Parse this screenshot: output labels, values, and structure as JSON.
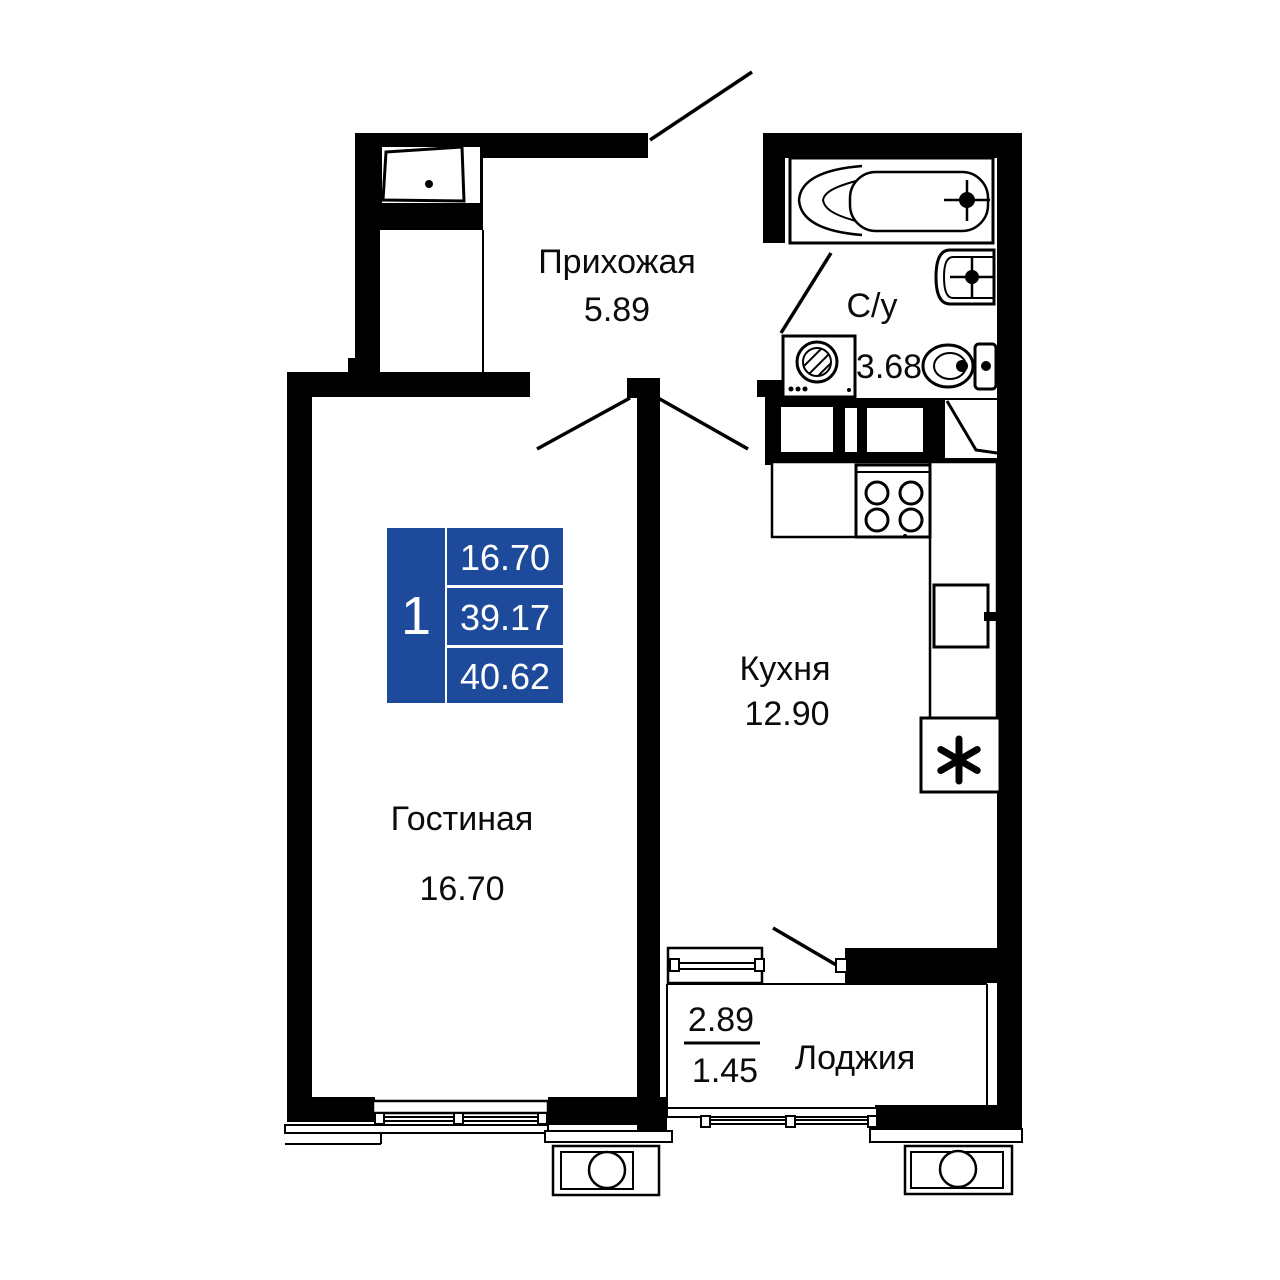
{
  "plan": {
    "background_color": "#ffffff",
    "wall_color": "#000000",
    "accent_blue": "#1d4a9b",
    "rooms": [
      {
        "id": "hallway",
        "label": "Прихожая",
        "area": "5.89"
      },
      {
        "id": "bathroom",
        "label": "С/у",
        "area": "3.68"
      },
      {
        "id": "kitchen",
        "label": "Кухня",
        "area": "12.90"
      },
      {
        "id": "living-room",
        "label": "Гостиная",
        "area": "16.70"
      },
      {
        "id": "loggia",
        "label": "Лоджия",
        "area_full": "2.89",
        "area_reduced": "1.45"
      }
    ],
    "legend": {
      "rooms_count": "1",
      "living_area": "16.70",
      "area_without_loggia": "39.17",
      "total_area": "40.62"
    },
    "fixtures": {
      "fridge_symbol": "*"
    }
  }
}
